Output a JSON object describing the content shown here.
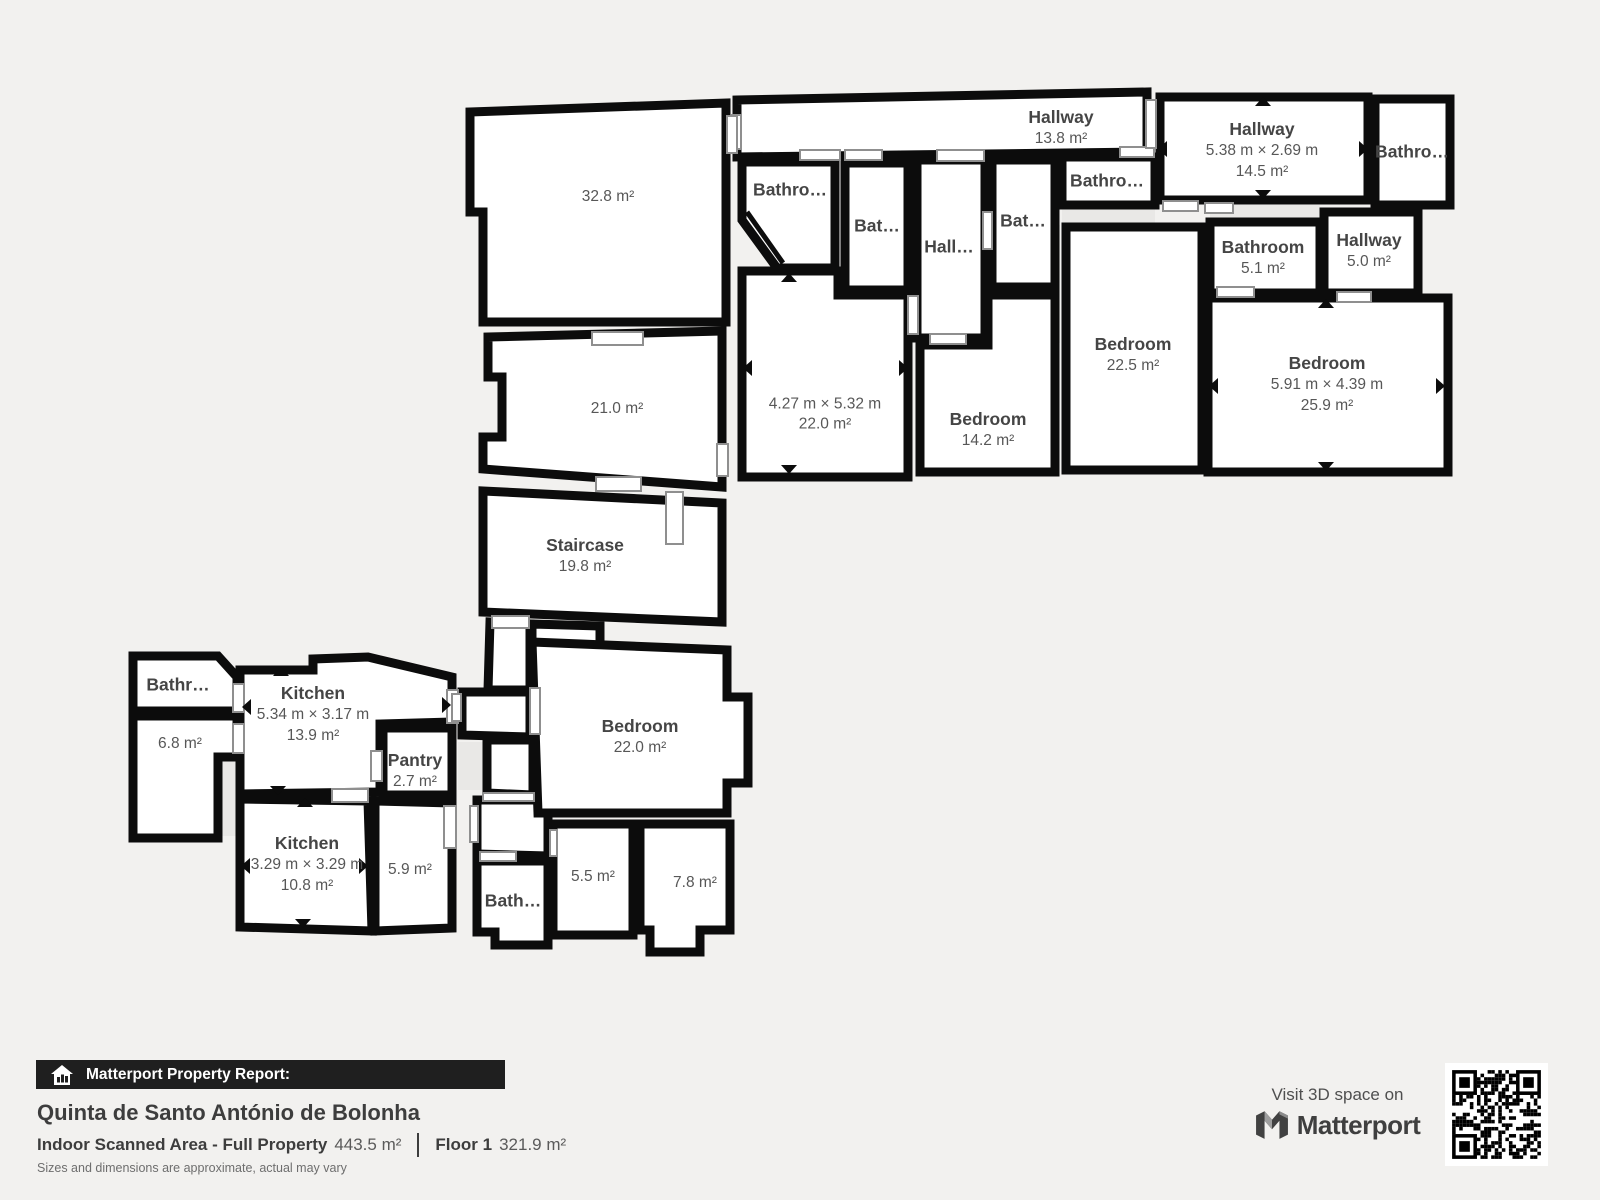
{
  "rooms": {
    "hallway_top": {
      "name": "Hallway",
      "area": "13.8 m²"
    },
    "room_32_8": {
      "area": "32.8 m²"
    },
    "room_21_0": {
      "area": "21.0 m²"
    },
    "staircase": {
      "name": "Staircase",
      "area": "19.8 m²"
    },
    "bathro_c1": {
      "name": "Bathro…"
    },
    "bat_1": {
      "name": "Bat…"
    },
    "hall_c": {
      "name": "Hall…"
    },
    "bat_2": {
      "name": "Bat…"
    },
    "bathro_c2": {
      "name": "Bathro…"
    },
    "hallway_right": {
      "name": "Hallway",
      "dims": "5.38 m × 2.69 m",
      "area": "14.5 m²"
    },
    "bathroom_tr": {
      "name": "Bathro…"
    },
    "bathroom_5_1": {
      "name": "Bathroom",
      "area": "5.1 m²"
    },
    "hallway_5_0": {
      "name": "Hallway",
      "area": "5.0 m²"
    },
    "bedroom_22_5": {
      "name": "Bedroom",
      "area": "22.5 m²"
    },
    "bedroom_25_9": {
      "name": "Bedroom",
      "dims": "5.91 m × 4.39 m",
      "area": "25.9 m²"
    },
    "room_4_27": {
      "dims": "4.27 m × 5.32 m",
      "area": "22.0 m²"
    },
    "bedroom_14_2": {
      "name": "Bedroom",
      "area": "14.2 m²"
    },
    "bathr_bl": {
      "name": "Bathr…"
    },
    "room_6_8": {
      "area": "6.8 m²"
    },
    "kitchen_1": {
      "name": "Kitchen",
      "dims": "5.34 m × 3.17 m",
      "area": "13.9 m²"
    },
    "pantry": {
      "name": "Pantry",
      "area": "2.7 m²"
    },
    "kitchen_2": {
      "name": "Kitchen",
      "dims": "3.29 m × 3.29 m",
      "area": "10.8 m²"
    },
    "room_5_9": {
      "area": "5.9 m²"
    },
    "bath_b": {
      "name": "Bath…"
    },
    "room_5_5": {
      "area": "5.5 m²"
    },
    "room_7_8": {
      "area": "7.8 m²"
    },
    "bedroom_22_0": {
      "name": "Bedroom",
      "area": "22.0 m²"
    }
  },
  "footer": {
    "report_label": "Matterport Property Report:",
    "property_name": "Quinta de Santo António de Bolonha",
    "area_label": "Indoor Scanned Area - Full Property",
    "area_value": "443.5 m²",
    "floor_label": "Floor 1",
    "floor_value": "321.9 m²",
    "disclaimer": "Sizes and dimensions are approximate, actual may vary"
  },
  "promo": {
    "visit_label": "Visit 3D space on",
    "brand": "Matterport"
  },
  "colors": {
    "background": "#f2f1ef",
    "walls": "#0c0c0c",
    "room_fill": "#ffffff",
    "door_stroke": "#8f8f8f",
    "label_text": "#4a4a4a",
    "footer_bar": "#1f1f1f"
  }
}
